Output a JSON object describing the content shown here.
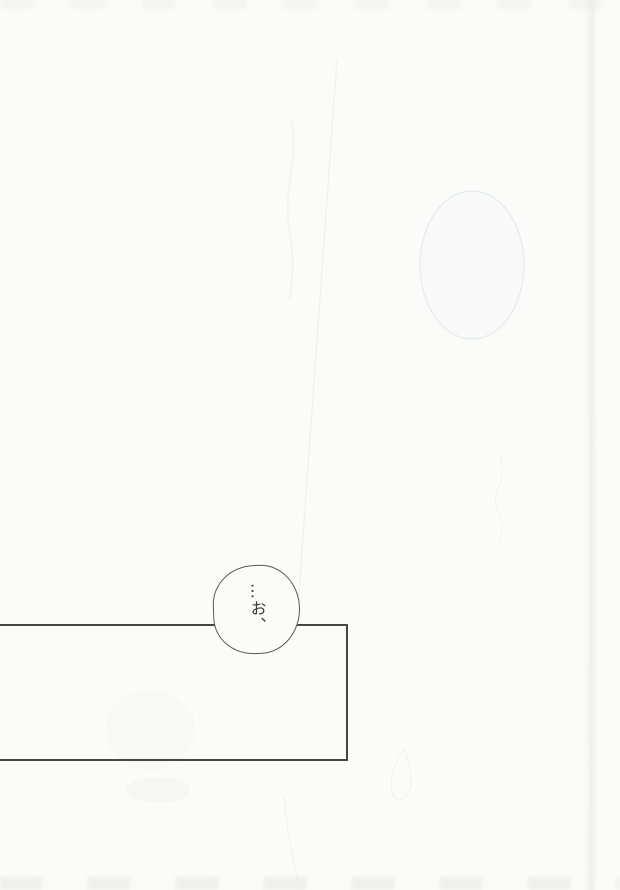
{
  "colors": {
    "paper": "#fbfbf9",
    "panel_ink": "#454543",
    "bubble_ink": "#5a5852",
    "text_ink": "#3d3b36"
  },
  "speech_bubble": {
    "text": "…お、"
  }
}
